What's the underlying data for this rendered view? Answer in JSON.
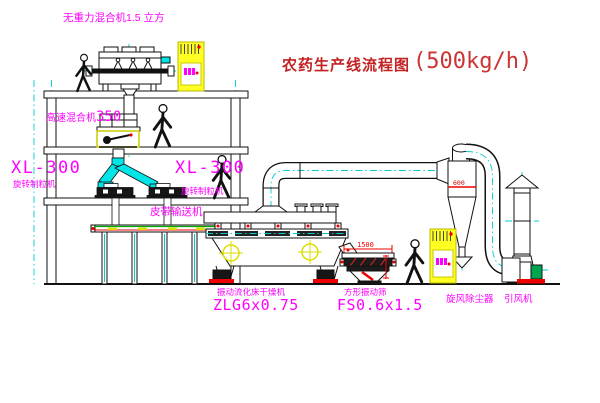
{
  "title": {
    "main": "农药生产线流程图",
    "capacity": "(500kg/h)"
  },
  "labels": {
    "gravity_mixer": "无重力混合机1.5 立方",
    "high_speed_mixer_name": "高速混合机",
    "high_speed_mixer_size": "350",
    "granulator_left_model": "XL-300",
    "granulator_left_name": "旋转制粒机",
    "granulator_right_model": "XL-300",
    "granulator_right_name": "旋转制粒机",
    "belt_conveyor": "皮带输送机",
    "dryer_name": "振动流化床干燥机",
    "dryer_model": "ZLG6x0.75",
    "sieve_name": "方形振动筛",
    "sieve_model": "FS0.6x1.5",
    "cyclone": "旋风除尘器",
    "fan": "引风机"
  },
  "dimensions": {
    "sieve_length": "1500",
    "cyclone_diameter": "600"
  },
  "colors": {
    "label_magenta": "#FF00FF",
    "title_red": "#C42222",
    "dimension_red": "#EE0000",
    "centerline_cyan": "#00CCCC",
    "pipe_cyan": "#00E5E5",
    "cabinet_yellow": "#FFFF22",
    "motor_green": "#00A550",
    "line_black": "#111111"
  }
}
